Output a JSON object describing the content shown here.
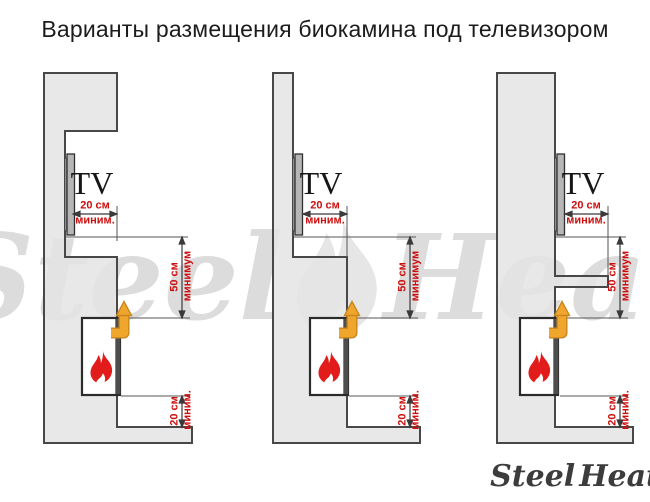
{
  "title": "Варианты размещения биокамина под телевизором",
  "watermark": {
    "word_left": "Steel",
    "word_right": "Heat"
  },
  "logo": {
    "word_left": "Steel",
    "word_right": "Heat"
  },
  "colors": {
    "dimension_red": "#cc0e0e",
    "flame_red": "#e21b1b",
    "vent_arrow_orange": "#f0a62c",
    "wall_gray": "#e4e4e4",
    "outline_gray": "#484848"
  },
  "diagrams": [
    {
      "tv_label": "TV",
      "dim_top_value": "20 см",
      "dim_top_note": "миним.",
      "dim_mid_value": "50 см",
      "dim_mid_note": "минимум",
      "dim_bottom_value": "20 см",
      "dim_bottom_note": "миним."
    },
    {
      "tv_label": "TV",
      "dim_top_value": "20 см",
      "dim_top_note": "миним.",
      "dim_mid_value": "50 см",
      "dim_mid_note": "минимум",
      "dim_bottom_value": "20 см",
      "dim_bottom_note": "миним."
    },
    {
      "tv_label": "TV",
      "dim_top_value": "20 см",
      "dim_top_note": "миним.",
      "dim_mid_value": "50 см",
      "dim_mid_note": "минимум",
      "dim_bottom_value": "20 см",
      "dim_bottom_note": "миним."
    }
  ]
}
